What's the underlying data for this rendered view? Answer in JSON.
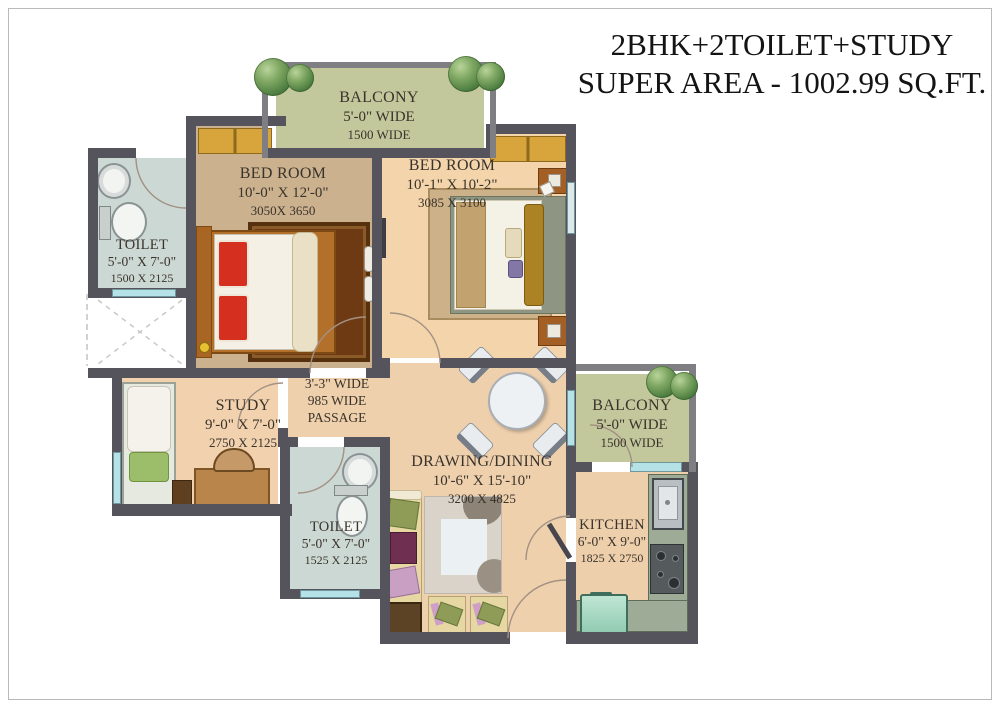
{
  "title": {
    "line1": "2BHK+2TOILET+STUDY",
    "line2": "SUPER AREA - 1002.99 SQ.FT."
  },
  "rooms": {
    "balcony_top": {
      "name": "BALCONY",
      "dim_ft": "5'-0\" WIDE",
      "dim_mm": "1500 WIDE"
    },
    "bedroom_left": {
      "name": "BED ROOM",
      "dim_ft": "10'-0\" X 12'-0\"",
      "dim_mm": "3050X 3650"
    },
    "bedroom_right": {
      "name": "BED ROOM",
      "dim_ft": "10'-1\" X 10'-2\"",
      "dim_mm": "3085 X 3100"
    },
    "toilet_left": {
      "name": "TOILET",
      "dim_ft": "5'-0\" X 7'-0\"",
      "dim_mm": "1500 X 2125"
    },
    "study": {
      "name": "STUDY",
      "dim_ft": "9'-0\" X 7'-0\"",
      "dim_mm": "2750 X 2125"
    },
    "passage": {
      "line1": "3'-3\" WIDE",
      "line2": "985 WIDE",
      "line3": "PASSAGE"
    },
    "drawing_dining": {
      "name": "DRAWING/DINING",
      "dim_ft": "10'-6\" X 15'-10\"",
      "dim_mm": "3200 X 4825"
    },
    "balcony_right": {
      "name": "BALCONY",
      "dim_ft": "5'-0\" WIDE",
      "dim_mm": "1500 WIDE"
    },
    "toilet_bottom": {
      "name": "TOILET",
      "dim_ft": "5'-0\" X 7'-0\"",
      "dim_mm": "1525 X 2125"
    },
    "kitchen": {
      "name": "KITCHEN",
      "dim_ft": "6'-0\" X 9'-0\"",
      "dim_mm": "1825 X 2750"
    }
  },
  "colors": {
    "wall": "#55545c",
    "balcony_wall": "#7e7e83",
    "floor_bedroom_left": "#cbb18e",
    "floor_peach": "#f2d3ac",
    "floor_balcony": "#c2c79c",
    "floor_toilet": "#ccd8d4",
    "window": "#b5e2e6",
    "wardrobe": "#d8a43c",
    "bed_pillow_red": "#d5301f",
    "counter_green": "#9dab97"
  }
}
